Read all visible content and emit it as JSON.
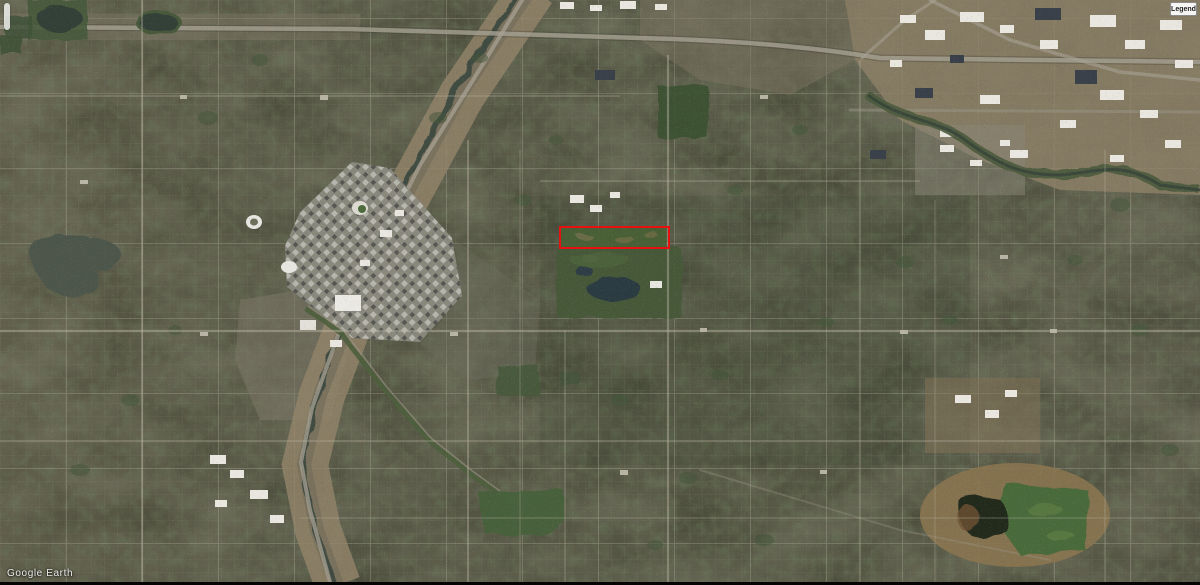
{
  "app": {
    "watermark_text": "Google Earth"
  },
  "legend_panel": {
    "label": "Legend"
  },
  "annotation": {
    "shape": "rectangle",
    "color": "#e81111",
    "box": {
      "left": 559,
      "top": 226,
      "width": 111,
      "height": 23
    }
  },
  "map_colors": {
    "urban_base": "#4f4f3e",
    "downtown_gray": "#8b8a80",
    "industrial_tan": "#93856a",
    "park_green": "#46593a",
    "water_dark": "#2c3a42",
    "road_light": "#a8a294",
    "annotation_red": "#e81111",
    "watermark_white": "#ffffff"
  }
}
